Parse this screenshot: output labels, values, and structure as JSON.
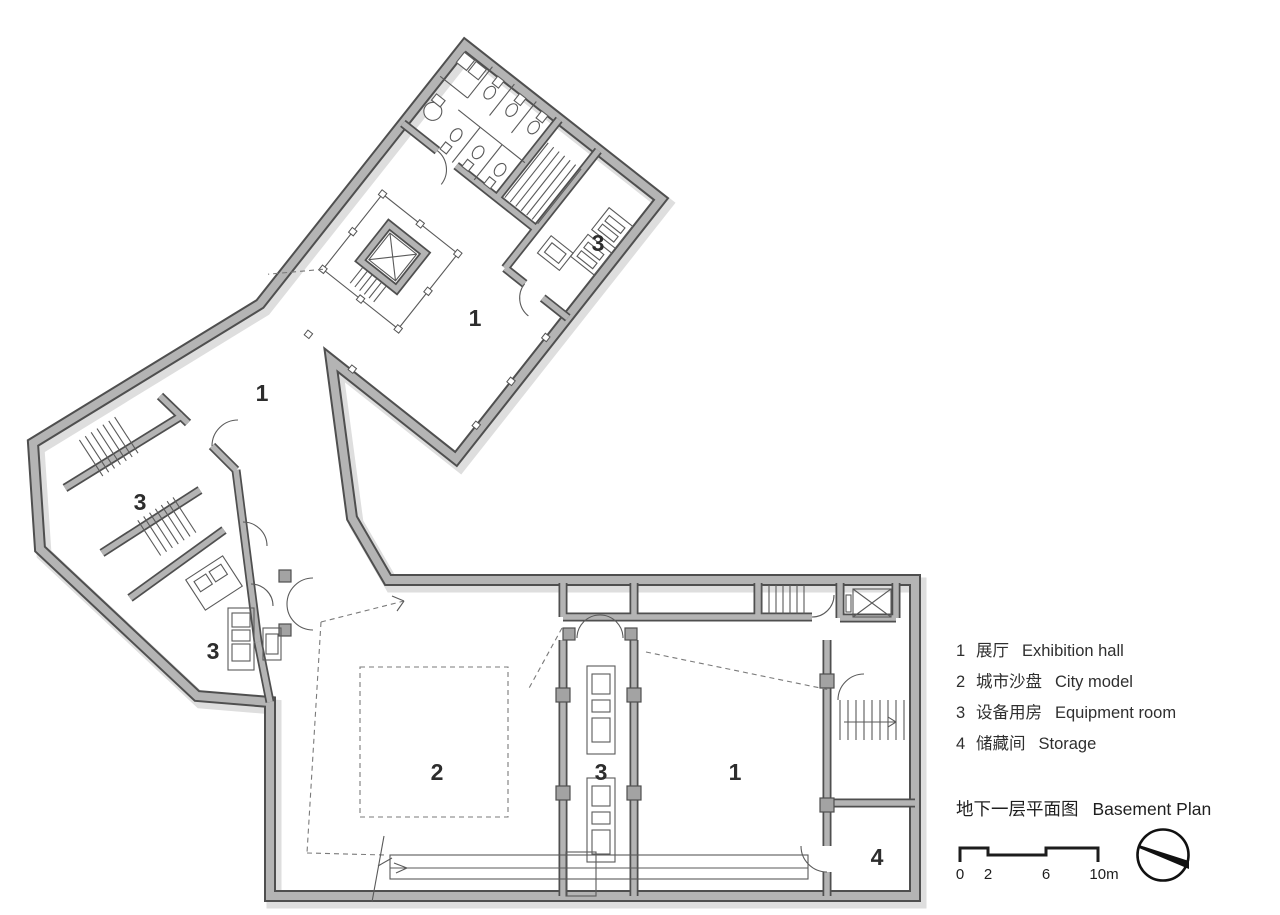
{
  "title": {
    "zh": "地下一层平面图",
    "en": "Basement Plan"
  },
  "legend": {
    "items": [
      {
        "num": "1",
        "zh": "展厅",
        "en": "Exhibition hall"
      },
      {
        "num": "2",
        "zh": "城市沙盘",
        "en": "City model"
      },
      {
        "num": "3",
        "zh": "设备用房",
        "en": "Equipment room"
      },
      {
        "num": "4",
        "zh": "储藏间",
        "en": "Storage"
      }
    ]
  },
  "scale_bar": {
    "labels": [
      "0",
      "2",
      "6",
      "10m"
    ]
  },
  "plan": {
    "room_labels": [
      {
        "text": "1",
        "x": 475,
        "y": 326
      },
      {
        "text": "3",
        "x": 598,
        "y": 251
      },
      {
        "text": "1",
        "x": 262,
        "y": 401
      },
      {
        "text": "3",
        "x": 140,
        "y": 510
      },
      {
        "text": "3",
        "x": 213,
        "y": 659
      },
      {
        "text": "2",
        "x": 437,
        "y": 780
      },
      {
        "text": "3",
        "x": 601,
        "y": 780
      },
      {
        "text": "1",
        "x": 735,
        "y": 780
      },
      {
        "text": "4",
        "x": 877,
        "y": 865
      }
    ]
  },
  "colors": {
    "wall_fill": "#b4b4b4",
    "wall_line": "#4f4f4f",
    "shadow": "#dedede",
    "thin_line": "#5a5a5a",
    "text": "#2f2f2f"
  }
}
